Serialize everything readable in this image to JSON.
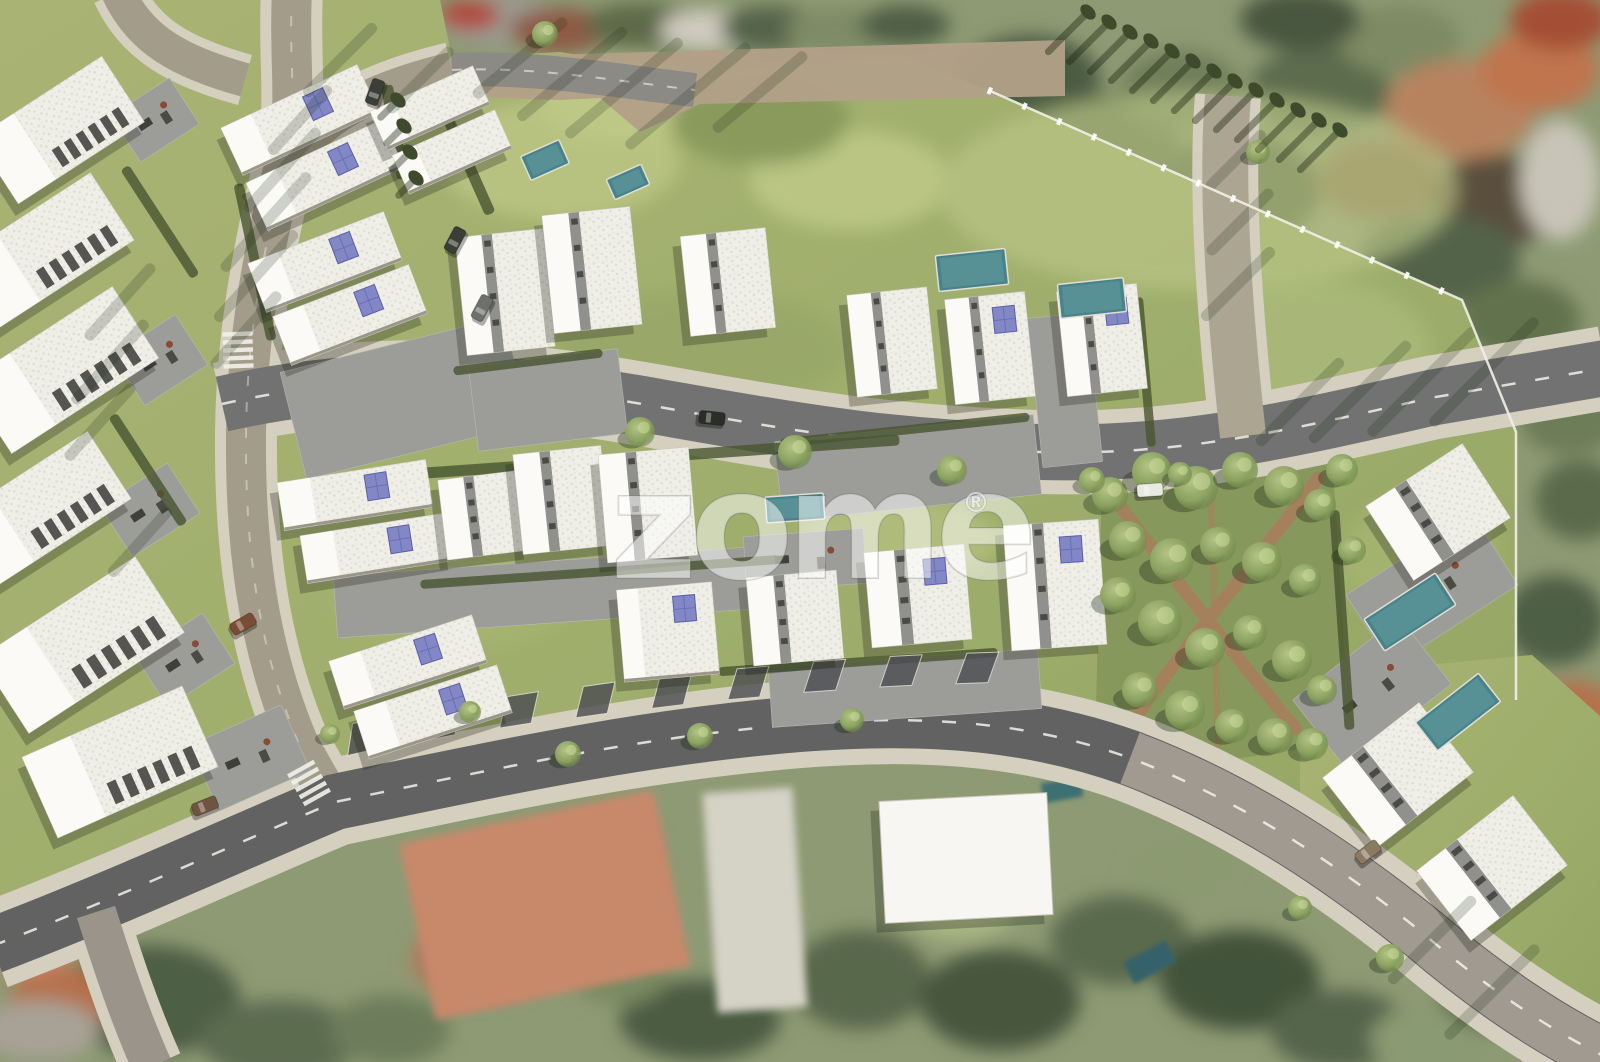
{
  "watermark": {
    "text": "zome",
    "registered_mark": "®"
  },
  "palette": {
    "lawn": "#a5b070",
    "lawn_light": "#c2cc8a",
    "lawn_dark": "#7d8f52",
    "park_green": "#87985d",
    "dirt_path": "#a87f5c",
    "asphalt_main": "#717271",
    "asphalt_bottom": "#616261",
    "asphalt_light": "#aca592",
    "road_tan": "#b2a088",
    "sidewalk": "#d5cfbf",
    "paver_gray": "#9c9d99",
    "building_white": "#f3f2ed",
    "building_plain": "#f7f6f2",
    "slot_gray": "#90918c",
    "pv_panel": "#8287c6",
    "pv_grid": "#5a5fa8",
    "pool_teal": "#47838a",
    "hedge_green": "#47552f",
    "tree_green": "#7f9757",
    "cypress_green": "#3d4b2c",
    "aerial_roof_orange": "#c0795a",
    "shadow": "rgba(35,40,30,0.30)",
    "road_marking": "#f2f2ea"
  },
  "scene": {
    "buildings": [
      {
        "cx": 60,
        "cy": 130,
        "w": 150,
        "h": 78,
        "rot": -33,
        "kind": "slab"
      },
      {
        "cx": 45,
        "cy": 250,
        "w": 160,
        "h": 80,
        "rot": -33,
        "kind": "slab"
      },
      {
        "cx": 62,
        "cy": 370,
        "w": 175,
        "h": 85,
        "rot": -33,
        "kind": "slab"
      },
      {
        "cx": 40,
        "cy": 510,
        "w": 165,
        "h": 80,
        "rot": -33,
        "kind": "slab"
      },
      {
        "cx": 82,
        "cy": 645,
        "w": 185,
        "h": 90,
        "rot": -33,
        "kind": "slab"
      },
      {
        "cx": 120,
        "cy": 762,
        "w": 175,
        "h": 88,
        "rot": -24,
        "kind": "slab"
      },
      {
        "cx": 300,
        "cy": 120,
        "w": 150,
        "h": 52,
        "rot": -25,
        "kind": "single",
        "pv": true
      },
      {
        "cx": 325,
        "cy": 175,
        "w": 150,
        "h": 52,
        "rot": -25,
        "kind": "single",
        "pv": true
      },
      {
        "cx": 430,
        "cy": 108,
        "w": 112,
        "h": 42,
        "rot": -24,
        "kind": "single"
      },
      {
        "cx": 452,
        "cy": 152,
        "w": 112,
        "h": 42,
        "rot": -24,
        "kind": "single"
      },
      {
        "cx": 325,
        "cy": 262,
        "w": 145,
        "h": 52,
        "rot": -21,
        "kind": "single",
        "pv": true
      },
      {
        "cx": 350,
        "cy": 315,
        "w": 145,
        "h": 52,
        "rot": -21,
        "kind": "single",
        "pv": true
      },
      {
        "cx": 505,
        "cy": 292,
        "w": 88,
        "h": 118,
        "rot": -6,
        "kind": "pair"
      },
      {
        "cx": 592,
        "cy": 270,
        "w": 88,
        "h": 118,
        "rot": -6,
        "kind": "pair"
      },
      {
        "cx": 728,
        "cy": 282,
        "w": 85,
        "h": 100,
        "rot": -6,
        "kind": "pair"
      },
      {
        "cx": 892,
        "cy": 342,
        "w": 80,
        "h": 102,
        "rot": -6,
        "kind": "pair"
      },
      {
        "cx": 990,
        "cy": 348,
        "w": 80,
        "h": 105,
        "rot": -6,
        "kind": "pair",
        "pv": true
      },
      {
        "cx": 1102,
        "cy": 340,
        "w": 80,
        "h": 105,
        "rot": -6,
        "kind": "pair",
        "pv": true
      },
      {
        "cx": 355,
        "cy": 495,
        "w": 150,
        "h": 48,
        "rot": -9,
        "kind": "single",
        "pv": true
      },
      {
        "cx": 378,
        "cy": 548,
        "w": 150,
        "h": 48,
        "rot": -9,
        "kind": "single",
        "pv": true
      },
      {
        "cx": 485,
        "cy": 515,
        "w": 85,
        "h": 80,
        "rot": -7,
        "kind": "pair"
      },
      {
        "cx": 562,
        "cy": 500,
        "w": 88,
        "h": 100,
        "rot": -6,
        "kind": "pair"
      },
      {
        "cx": 648,
        "cy": 505,
        "w": 90,
        "h": 108,
        "rot": -5,
        "kind": "pair"
      },
      {
        "cx": 408,
        "cy": 662,
        "w": 150,
        "h": 50,
        "rot": -18,
        "kind": "single",
        "pv": true
      },
      {
        "cx": 433,
        "cy": 712,
        "w": 150,
        "h": 50,
        "rot": -18,
        "kind": "single",
        "pv": true
      },
      {
        "cx": 668,
        "cy": 632,
        "w": 95,
        "h": 92,
        "rot": -5,
        "kind": "single",
        "pv": true
      },
      {
        "cx": 795,
        "cy": 618,
        "w": 90,
        "h": 88,
        "rot": -5,
        "kind": "pair"
      },
      {
        "cx": 918,
        "cy": 596,
        "w": 100,
        "h": 95,
        "rot": -5,
        "kind": "pair",
        "pv": true
      },
      {
        "cx": 1055,
        "cy": 585,
        "w": 95,
        "h": 125,
        "rot": -4,
        "kind": "pair",
        "pv": true
      },
      {
        "cx": 1438,
        "cy": 512,
        "w": 115,
        "h": 88,
        "rot": -33,
        "kind": "pair"
      },
      {
        "cx": 1398,
        "cy": 775,
        "w": 122,
        "h": 88,
        "rot": -38,
        "kind": "pair"
      },
      {
        "cx": 1492,
        "cy": 868,
        "w": 122,
        "h": 88,
        "rot": -38,
        "kind": "pair"
      },
      {
        "cx": 966,
        "cy": 858,
        "w": 168,
        "h": 122,
        "rot": -3,
        "kind": "plain"
      }
    ],
    "patios": [
      {
        "x": 155,
        "y": 120,
        "w": 70,
        "h": 55,
        "rot": -33,
        "f": 1
      },
      {
        "x": 160,
        "y": 360,
        "w": 75,
        "h": 60,
        "rot": -33,
        "f": 1
      },
      {
        "x": 150,
        "y": 510,
        "w": 80,
        "h": 60,
        "rot": -33,
        "f": 1
      },
      {
        "x": 185,
        "y": 660,
        "w": 80,
        "h": 60,
        "rot": -33,
        "f": 1
      },
      {
        "x": 250,
        "y": 758,
        "w": 100,
        "h": 72,
        "rot": -24,
        "f": 1
      },
      {
        "x": 405,
        "y": 398,
        "w": 230,
        "h": 110,
        "rot": -14,
        "f": 0
      },
      {
        "x": 548,
        "y": 400,
        "w": 150,
        "h": 85,
        "rot": -7,
        "f": 0
      },
      {
        "x": 908,
        "y": 468,
        "w": 260,
        "h": 80,
        "rot": -6,
        "f": 0
      },
      {
        "x": 550,
        "y": 592,
        "w": 430,
        "h": 62,
        "rot": -4,
        "f": 0
      },
      {
        "x": 905,
        "y": 688,
        "w": 270,
        "h": 60,
        "rot": -4,
        "f": 0
      },
      {
        "x": 805,
        "y": 560,
        "w": 120,
        "h": 55,
        "rot": -4,
        "f": 1
      },
      {
        "x": 1065,
        "y": 390,
        "w": 60,
        "h": 150,
        "rot": -6,
        "f": 0
      },
      {
        "x": 1432,
        "y": 590,
        "w": 150,
        "h": 85,
        "rot": -33,
        "f": 1
      },
      {
        "x": 1372,
        "y": 692,
        "w": 135,
        "h": 85,
        "rot": -38,
        "f": 1
      }
    ],
    "pools": [
      {
        "x": 545,
        "y": 160,
        "w": 42,
        "h": 26,
        "rot": -24
      },
      {
        "x": 628,
        "y": 182,
        "w": 38,
        "h": 22,
        "rot": -24
      },
      {
        "x": 972,
        "y": 270,
        "w": 70,
        "h": 36,
        "rot": -6
      },
      {
        "x": 1092,
        "y": 298,
        "w": 66,
        "h": 34,
        "rot": -6
      },
      {
        "x": 795,
        "y": 508,
        "w": 58,
        "h": 26,
        "rot": -4
      },
      {
        "x": 1410,
        "y": 612,
        "w": 85,
        "h": 38,
        "rot": -33
      },
      {
        "x": 1458,
        "y": 712,
        "w": 80,
        "h": 36,
        "rot": -38
      }
    ],
    "hedges": [
      [
        640,
        458,
        520,
        11,
        -4
      ],
      [
        600,
        572,
        360,
        9,
        -4
      ],
      [
        858,
        662,
        280,
        9,
        -4
      ],
      [
        255,
        262,
        10,
        160,
        -12
      ],
      [
        462,
        150,
        11,
        140,
        -24
      ],
      [
        1342,
        620,
        10,
        220,
        -4
      ],
      [
        160,
        222,
        10,
        130,
        -33
      ],
      [
        148,
        470,
        10,
        130,
        -33
      ],
      [
        528,
        362,
        150,
        9,
        -7
      ],
      [
        905,
        430,
        250,
        9,
        -6
      ],
      [
        395,
        132,
        12,
        95,
        -10
      ],
      [
        1145,
        372,
        9,
        150,
        -5
      ]
    ],
    "trees": [
      [
        1110,
        495,
        18
      ],
      [
        1152,
        472,
        20
      ],
      [
        1196,
        488,
        22
      ],
      [
        1240,
        470,
        18
      ],
      [
        1284,
        486,
        20
      ],
      [
        1320,
        505,
        16
      ],
      [
        1128,
        540,
        19
      ],
      [
        1172,
        560,
        22
      ],
      [
        1218,
        545,
        18
      ],
      [
        1262,
        562,
        20
      ],
      [
        1305,
        580,
        16
      ],
      [
        1118,
        595,
        18
      ],
      [
        1160,
        622,
        22
      ],
      [
        1205,
        648,
        20
      ],
      [
        1250,
        632,
        17
      ],
      [
        1292,
        660,
        20
      ],
      [
        1322,
        690,
        15
      ],
      [
        1140,
        690,
        18
      ],
      [
        1185,
        710,
        20
      ],
      [
        1232,
        726,
        17
      ],
      [
        1275,
        736,
        18
      ],
      [
        640,
        432,
        15
      ],
      [
        795,
        452,
        17
      ],
      [
        952,
        470,
        15
      ],
      [
        1092,
        480,
        13
      ],
      [
        1180,
        474,
        12
      ],
      [
        568,
        754,
        13
      ],
      [
        700,
        736,
        13
      ],
      [
        852,
        720,
        12
      ],
      [
        545,
        34,
        13
      ],
      [
        1342,
        470,
        16
      ],
      [
        1352,
        550,
        14
      ],
      [
        1312,
        744,
        16
      ],
      [
        1390,
        958,
        14
      ],
      [
        1300,
        908,
        12
      ],
      [
        330,
        734,
        10
      ],
      [
        1258,
        152,
        12
      ],
      [
        470,
        712,
        11
      ]
    ],
    "cypresses": [
      [
        1088,
        12,
        55
      ],
      [
        1109,
        22,
        55
      ],
      [
        1130,
        32,
        55
      ],
      [
        1151,
        41,
        55
      ],
      [
        1172,
        51,
        55
      ],
      [
        1193,
        61,
        55
      ],
      [
        1214,
        71,
        55
      ],
      [
        1235,
        81,
        55
      ],
      [
        1256,
        90,
        55
      ],
      [
        1277,
        100,
        55
      ],
      [
        1298,
        110,
        55
      ],
      [
        1319,
        120,
        55
      ],
      [
        1340,
        130,
        55
      ],
      [
        398,
        100,
        24
      ],
      [
        404,
        126,
        24
      ],
      [
        410,
        152,
        24
      ],
      [
        416,
        178,
        24
      ]
    ],
    "cars": [
      {
        "x": 712,
        "y": 418,
        "rot": 6,
        "c": "#2a2e26"
      },
      {
        "x": 375,
        "y": 92,
        "rot": -70,
        "c": "#3c3f38"
      },
      {
        "x": 455,
        "y": 240,
        "rot": -62,
        "c": "#3a3d38"
      },
      {
        "x": 482,
        "y": 308,
        "rot": -62,
        "c": "#6e706b"
      },
      {
        "x": 243,
        "y": 624,
        "rot": -30,
        "c": "#7a4c34"
      },
      {
        "x": 1150,
        "y": 490,
        "rot": -4,
        "c": "#e9e9e4"
      },
      {
        "x": 205,
        "y": 806,
        "rot": -22,
        "c": "#6f5440"
      },
      {
        "x": 1368,
        "y": 852,
        "rot": -38,
        "c": "#8a7a5f"
      }
    ],
    "crosswalks": [
      [
        309,
        783,
        61
      ],
      [
        238,
        350,
        88
      ]
    ],
    "parking_bays": [
      [
        368,
        755,
        -13
      ],
      [
        444,
        741,
        -11
      ],
      [
        520,
        729,
        -9
      ],
      [
        596,
        719,
        -8
      ],
      [
        672,
        710,
        -7
      ],
      [
        748,
        702,
        -5
      ],
      [
        824,
        695,
        -4
      ],
      [
        900,
        690,
        -3
      ],
      [
        976,
        687,
        -2
      ]
    ],
    "shadow_stripes": [
      [
        300,
        120,
        90,
        -48
      ],
      [
        282,
        170,
        110,
        -48
      ],
      [
        266,
        222,
        130,
        -48
      ],
      [
        256,
        276,
        120,
        -48
      ],
      [
        246,
        330,
        100,
        -48
      ],
      [
        520,
        58,
        120,
        -40
      ],
      [
        572,
        74,
        140,
        -40
      ],
      [
        624,
        88,
        150,
        -40
      ],
      [
        688,
        96,
        160,
        -40
      ],
      [
        760,
        92,
        120,
        -40
      ],
      [
        1300,
        402,
        120,
        -45
      ],
      [
        1360,
        392,
        140,
        -45
      ],
      [
        1422,
        382,
        150,
        -45
      ],
      [
        1484,
        372,
        150,
        -45
      ],
      [
        1236,
        160,
        80,
        -45
      ],
      [
        1240,
        222,
        90,
        -45
      ],
      [
        1238,
        284,
        100,
        -45
      ],
      [
        1432,
        940,
        120,
        -45
      ],
      [
        1492,
        992,
        130,
        -45
      ],
      [
        120,
        302,
        100,
        -48
      ],
      [
        110,
        362,
        110,
        -48
      ],
      [
        100,
        422,
        100,
        -48
      ],
      [
        140,
        542,
        90,
        -48
      ],
      [
        340,
        60,
        100,
        -45
      ],
      [
        420,
        80,
        90,
        -45
      ]
    ]
  }
}
